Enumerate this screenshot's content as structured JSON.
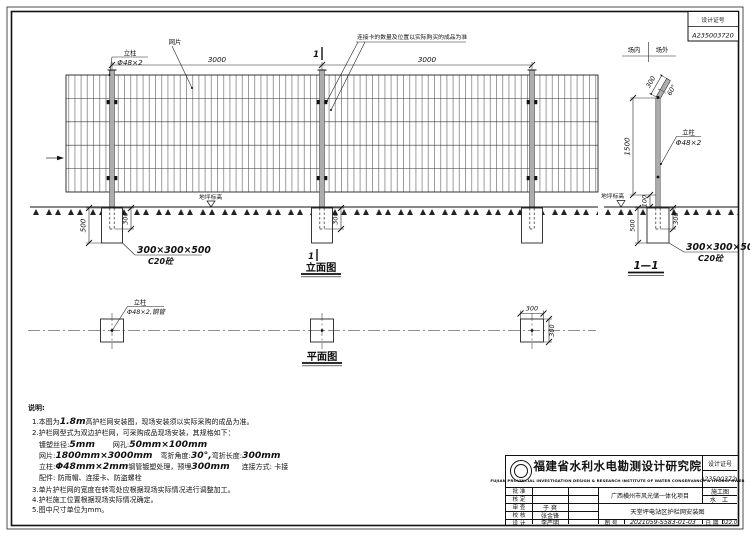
{
  "corner_box": {
    "label": "设计证号",
    "value": "A235003720"
  },
  "elevation": {
    "title": "立面图",
    "span_dims": [
      "3000",
      "3000"
    ],
    "post_label": "立柱",
    "post_spec": "Φ48×2",
    "mesh_label": "网片",
    "clip_note": "连接卡的数量及位置以实际购买的成品为准",
    "section_mark": "1",
    "ground_label": "地坪标高",
    "dim_depth": "500",
    "dim_embed": "300",
    "dim_embed_mid": "300",
    "foundation_size": "300×300×500",
    "foundation_material": "C20砼"
  },
  "section": {
    "title": "1—1",
    "inside": "场内",
    "outside": "场外",
    "arm_dim": "300",
    "arm_angle": "60°",
    "dim_height": "1500",
    "dim_gap": "100",
    "post_label": "立柱",
    "post_spec": "Φ48×2",
    "ground_label": "地坪标高",
    "dim_depth": "500",
    "dim_embed": "300",
    "foundation_size": "300×300×500",
    "foundation_material": "C20砼"
  },
  "plan": {
    "title": "平面图",
    "post_label": "立柱",
    "post_spec": "Φ48×2,钢管",
    "dim_w": "300",
    "dim_h": "300"
  },
  "notes": {
    "heading": "说明:",
    "n1a": "1.本图为",
    "n1b": "1.8m",
    "n1c": "高护栏网安装图，现场安装须以实际采购的成品为准。",
    "n2": "2.护栏网型式为双边护栏网，可采购成品现场安装，其规格如下：",
    "s1a": "镀塑丝径:",
    "s1b": "5mm",
    "s1c": "网孔:",
    "s1d": "50mm×100mm",
    "s2a": "网片:",
    "s2b": "1800mm×3000mm",
    "s2c": "弯折角度:",
    "s2d": "30°,",
    "s2e": "弯折长度:",
    "s2f": "300mm",
    "s3a": "立柱:",
    "s3b": "Φ48mm×2mm",
    "s3c": "钢管镀塑处理，预埋",
    "s3d": "300mm",
    "s3e": "连接方式: 卡接",
    "s4": "配件: 防雨帽、连接卡、防盗螺栓",
    "n3": "3.单片护栏网的宽度在转弯处应根据现场实际情况进行调整加工。",
    "n4": "4.护栏施工位置根据现场实际情况确定。",
    "n5": "5.图中尺寸单位为mm。"
  },
  "title_block": {
    "institute_cn": "福建省水利水电勘测设计研究院",
    "institute_en": "FUJIAN PROVINCIAL INVESTIGATION DESIGN & RESEARCH INSTITUTE OF WATER CONSERVANCY & HYDROPOWER",
    "cert_label": "设计证号",
    "cert_no": "A235003720",
    "approve_label": "批 准",
    "verify_label": "核 定",
    "review_label": "审 查",
    "check_label": "校 核",
    "design_label": "设 计",
    "review_name": "于 爽",
    "check_name": "张金锋",
    "design_name": "李严明",
    "project": "广西横州市风光储一体化项目",
    "stage": "施工图",
    "specialty": "水 工",
    "drawing_title": "天堂坪电站区护栏网安装图",
    "fig_label": "图 号",
    "fig_no": "2021059-S583-01-03",
    "date_label": "日 期",
    "date": "2022.03"
  }
}
